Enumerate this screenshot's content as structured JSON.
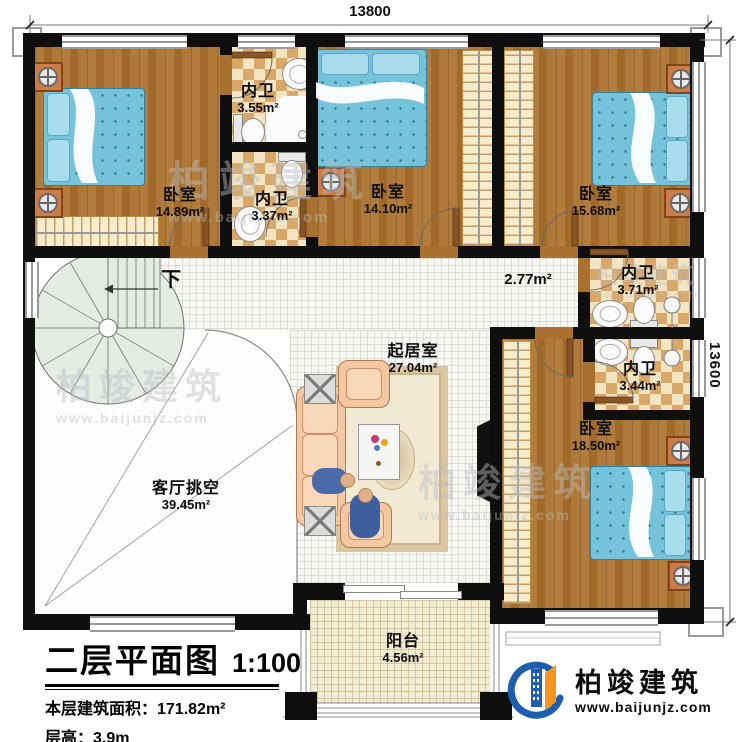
{
  "plan": {
    "dimension_top": "13800",
    "dimension_right": "13600",
    "stair_down_label": "下"
  },
  "rooms": {
    "bedroom_tl": {
      "name": "卧室",
      "area": "14.89m²"
    },
    "bath_a": {
      "name": "内卫",
      "area": "3.55m²"
    },
    "bath_b": {
      "name": "内卫",
      "area": "3.37m²"
    },
    "bedroom_tm": {
      "name": "卧室",
      "area": "14.10m²"
    },
    "bedroom_tr": {
      "name": "卧室",
      "area": "15.68m²"
    },
    "bath_c": {
      "name": "内卫",
      "area": "3.71m²"
    },
    "bath_d": {
      "name": "内卫",
      "area": "3.44m²"
    },
    "hallway": {
      "area": "2.77m²"
    },
    "living": {
      "name": "起居室",
      "area": "27.04m²"
    },
    "bedroom_br": {
      "name": "卧室",
      "area": "18.50m²"
    },
    "void": {
      "name": "客厅挑空",
      "area": "39.45m²"
    },
    "balcony": {
      "name": "阳台",
      "area": "4.56m²"
    }
  },
  "title_block": {
    "title": "二层平面图",
    "scale": "1:100",
    "floor_area": "本层建筑面积：171.82m²",
    "floor_height": "层高：3.9m"
  },
  "brand": {
    "name": "柏竣建筑",
    "website": "www.baijunjz.com"
  },
  "watermark": {
    "name": "柏竣建筑",
    "website": "www.baijunjz.com"
  },
  "colors": {
    "wall": "#0f0f0f",
    "wood_floor": "#a9712f",
    "bath_tile": "#d9a768",
    "bed_blue": "#74c3da",
    "brand_blue": "#1d5fae",
    "brand_orange": "#f6921e"
  }
}
